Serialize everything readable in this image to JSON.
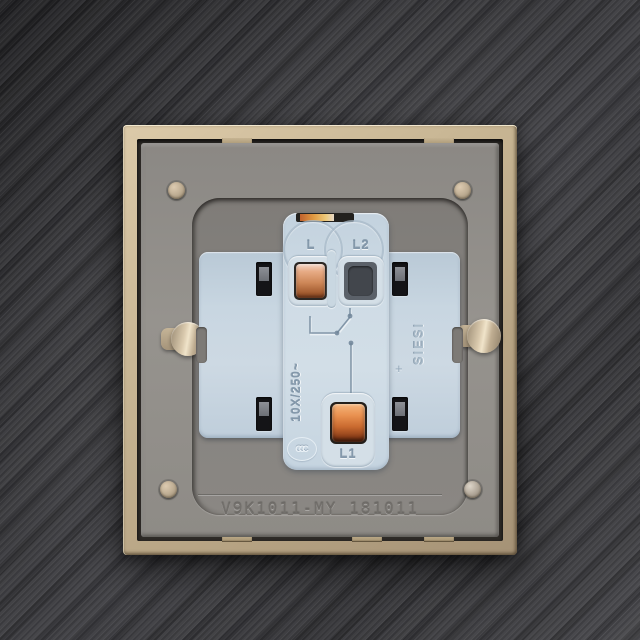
{
  "scene": {
    "device": {
      "terminals": {
        "top_left_label": "L",
        "top_right_label": "L2",
        "bottom_label": "L1"
      },
      "markings": {
        "rating": "10X/250~",
        "brand": "SIESI",
        "certification": "CCC",
        "plus_mark": "+",
        "model_code": "V9K1011-MY 181011"
      },
      "colors": {
        "background_metal": "#3c3c40",
        "frame_gold": "#c8b694",
        "plate_gray": "#908d88",
        "recess_gray": "#828078",
        "module_blue": "#c8d6e1",
        "copper_terminal": "#cd8758",
        "copper_bright": "#e99150",
        "slot_black": "#141417",
        "rivet_beige": "#c1b096",
        "keyhole_metal": "#d9c9ad"
      }
    }
  }
}
